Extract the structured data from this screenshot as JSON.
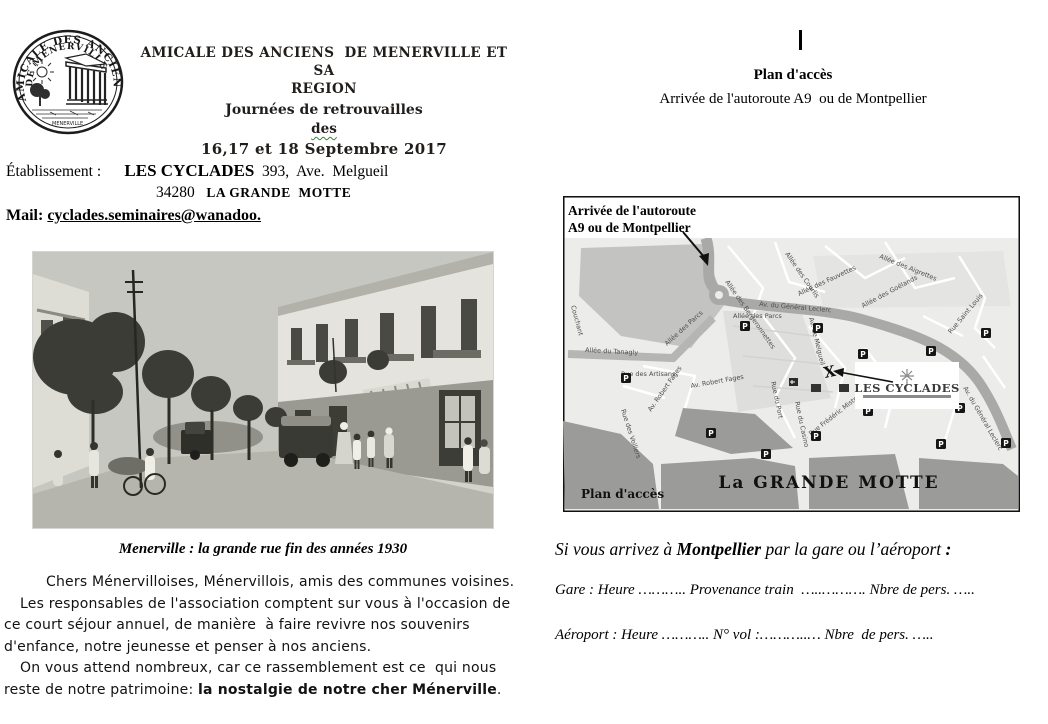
{
  "left": {
    "logo": {
      "ring_text_top": "AMICALE DES ANCIENS",
      "ring_text_inner": "DE MENERVILLE",
      "base_text": "MENERVILLE"
    },
    "header": {
      "line1": "AMICALE DES ANCIENS  DE MENERVILLE ET SA",
      "line2": "REGION",
      "line3": "Journées de retrouvailles",
      "line4": "des",
      "line5": "16,17 et 18 Septembre 2017"
    },
    "establishment": {
      "label": "Établissement :",
      "name": "LES CYCLADES",
      "address": "393,  Ave.  Melgueil",
      "zip": "34280",
      "city": "LA GRANDE  MOTTE"
    },
    "mail": {
      "label": "Mail:",
      "value": "cyclades.seminaires@wanadoo."
    },
    "photo_caption": "Menerville : la grande rue fin des années 1930",
    "paragraph": {
      "p1": "Chers Ménervilloises, Ménervillois, amis des communes voisines.",
      "p2": "Les responsables de l'association comptent sur vous à l'occasion de ce court séjour annuel, de manière  à faire revivre nos souvenirs d'enfance, notre jeunesse et penser à nos anciens.",
      "p3_prefix": "On vous attend nombreux, car ce rassemblement est ce  qui nous reste de notre patrimoine: ",
      "p3_bold": "la nostalgie de notre cher Ménerville",
      "p3_suffix": "."
    }
  },
  "right": {
    "cursor": "|",
    "title": "Plan d'accès",
    "subtitle": "Arrivée de l'autoroute A9  ou de Montpellier",
    "map": {
      "label_line1": "Arrivée de l'autoroute",
      "label_line2": "A9  ou de Montpellier",
      "hotel_label": "LES CYCLADES",
      "marker": "X",
      "parking_icon": "P",
      "city_label": "La GRANDE MOTTE",
      "corner_label": "Plan d'accès",
      "street_labels": [
        "Av. du Général Leclerc",
        "Allée des Parcs",
        "Allée du Tanagly",
        "Rue des Artisans",
        "Rue des Voiliers",
        "Av. Robert Fages",
        "Av. de Melgueil",
        "Rue du Port",
        "Rue du Casino",
        "Rue Frédéric Mistral",
        "Rue Saint Louis",
        "Allée des Bergeronnettes",
        "Allée des Courlis",
        "Allée des Fauvettes",
        "Allée des Goélands",
        "Allée des Aigrettes",
        "Couchant"
      ]
    },
    "arrival": {
      "intro_prefix": "Si vous arrivez à ",
      "intro_bold": "Montpellier",
      "intro_middle": " par la gare ou l’aéroport ",
      "intro_colon": ":",
      "gare_line": "Gare : Heure ……….. Provenance train  …..………. Nbre de pers. …..",
      "aeroport_line": "Aéroport : Heure ……….. N° vol :………..… Nbre  de pers. ….."
    }
  }
}
